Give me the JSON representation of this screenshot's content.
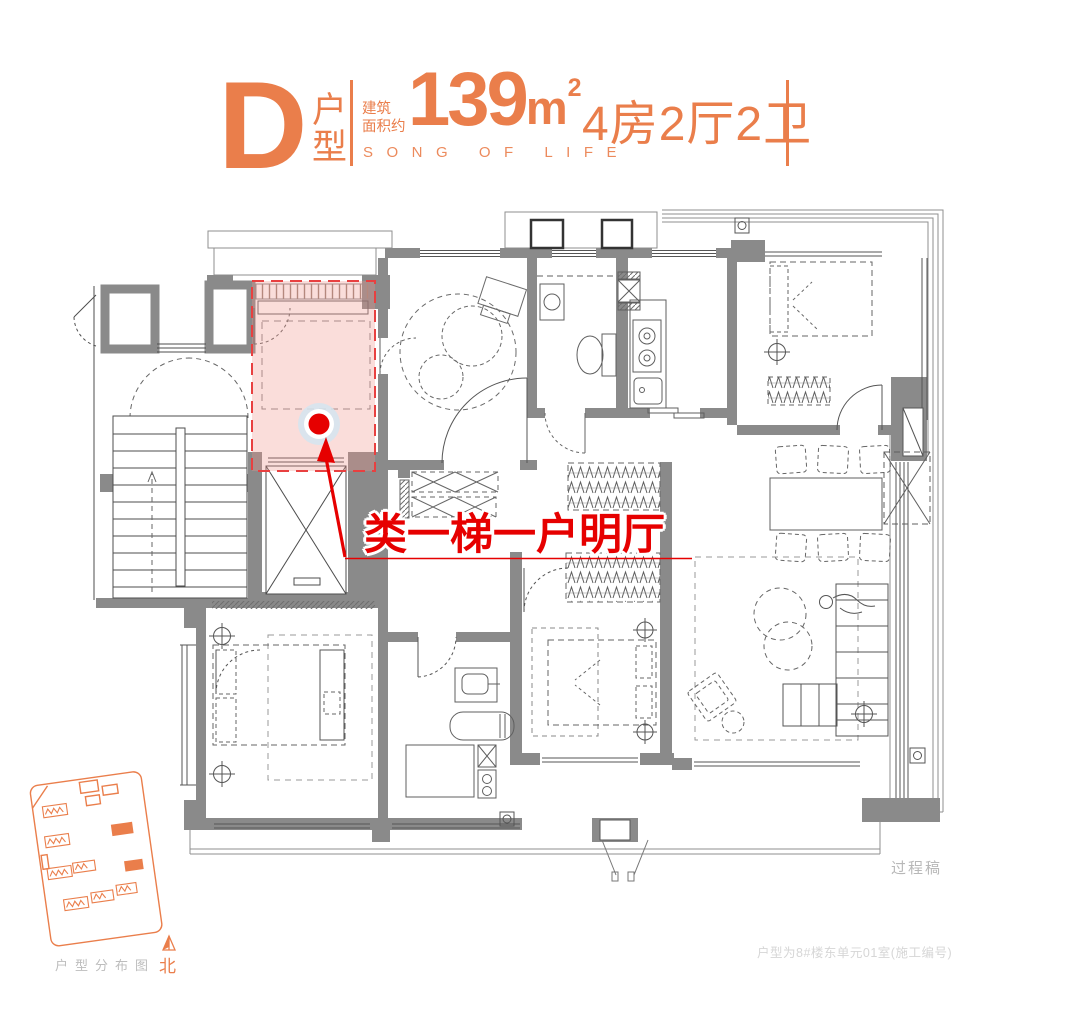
{
  "header": {
    "type_letter": "D",
    "type_label_top": "户",
    "type_label_bottom": "型",
    "area_label_top": "建筑",
    "area_label_bottom": "面积约",
    "area_value": "139",
    "area_unit": "m",
    "area_exponent": "2",
    "layout_text": "4房2厅2卫",
    "slogan": "SONG OF LIFE"
  },
  "annotation": {
    "text": "类一梯一户明厅"
  },
  "site_map": {
    "caption": "户型分布图",
    "north_label": "北"
  },
  "notes": {
    "draft": "过程稿",
    "unit": "户型为8#楼东单元01室(施工编号)"
  },
  "colors": {
    "accent": "#EA7E4B",
    "annotation_red": "#E60000",
    "wall_gray": "#8A8A8A",
    "highlight_pink": "#F0958B"
  }
}
